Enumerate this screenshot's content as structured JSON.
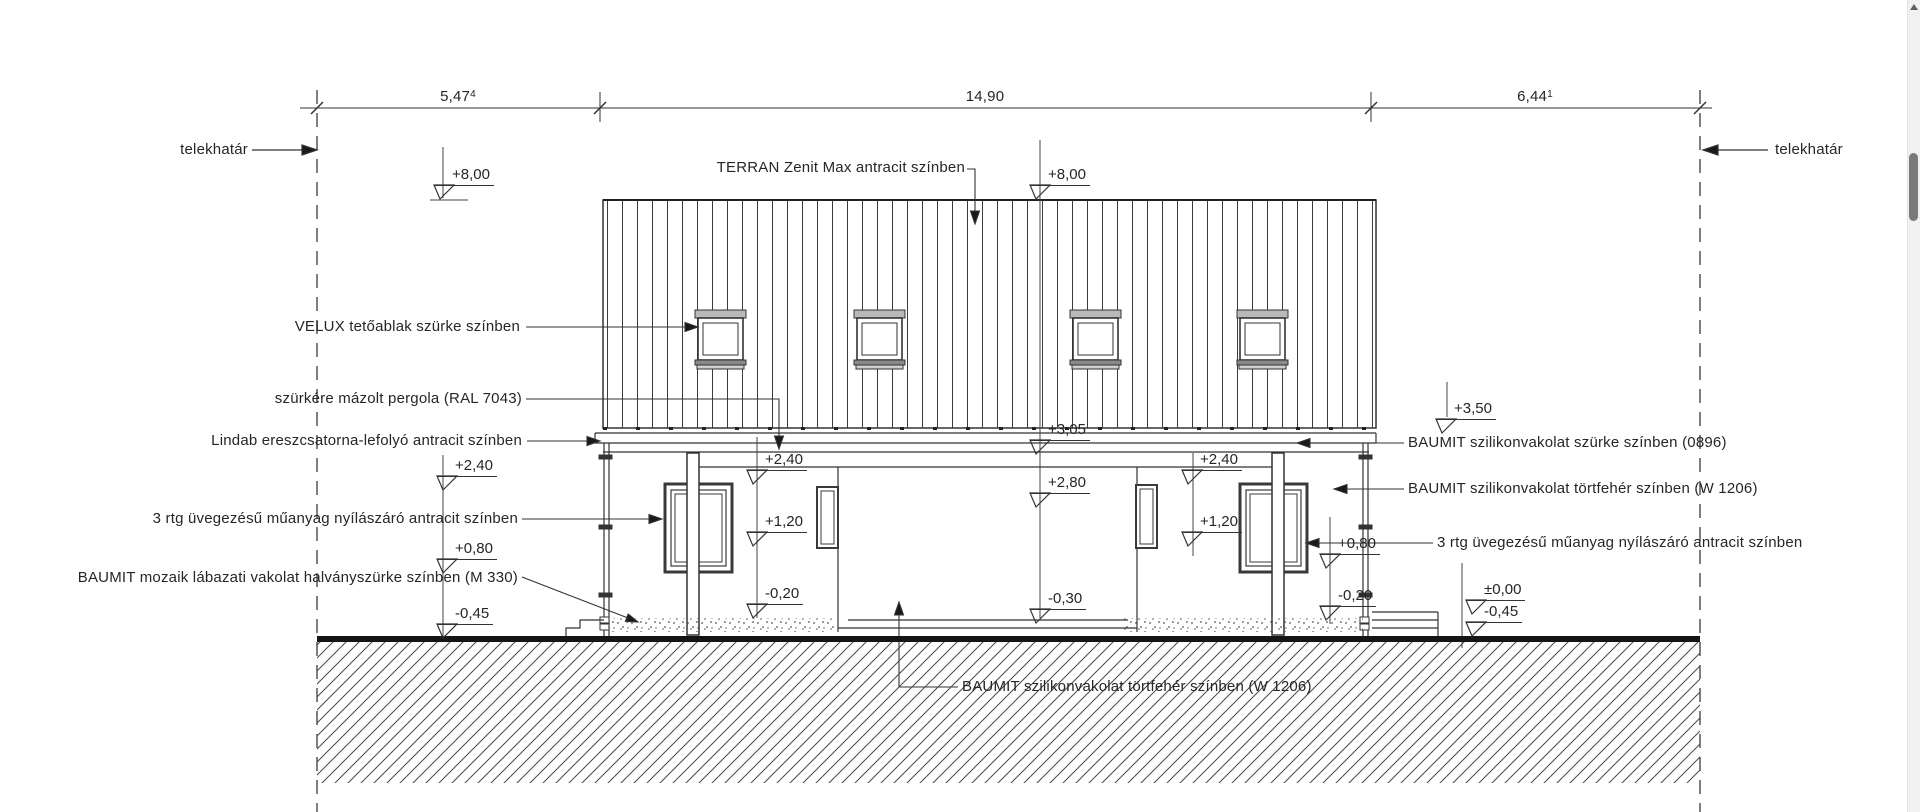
{
  "dimension_row": {
    "segments": [
      {
        "value": "5,47",
        "sup": "4"
      },
      {
        "value": "14,90",
        "sup": ""
      },
      {
        "value": "6,44",
        "sup": "1"
      }
    ]
  },
  "boundary": {
    "left_label": "telekhatár",
    "right_label": "telekhatár"
  },
  "callouts": {
    "roof": "TERRAN Zenit Max antracit színben",
    "velux": "VELUX tetőablak szürke színben",
    "pergola": "szürkére mázolt pergola (RAL 7043)",
    "lindab": "Lindab ereszcsatorna-lefolyó antracit színben",
    "window_left": "3 rtg üvegezésű műanyag nyílászáró antracit színben",
    "plinth": "BAUMIT mozaik lábazati vakolat halványszürke színben (M 330)",
    "render_grey": "BAUMIT szilikonvakolat szürke színben (0896)",
    "render_offwhite": "BAUMIT szilikonvakolat törtfehér színben (W 1206)",
    "window_right": "3 rtg üvegezésű műanyag nyílászáró antracit színben",
    "render_offwhite_bottom": "BAUMIT szilikonvakolat törtfehér színben (W 1206)"
  },
  "elevations": {
    "ridge_left": "+8,00",
    "ridge_center": "+8,00",
    "eave": "+3,05",
    "parapet_right": "+3,50",
    "left_240": "+2,40",
    "left_080": "+0,80",
    "left_045": "-0,45",
    "porch_240": "+2,40",
    "porch_120": "+1,20",
    "porch_020": "-0,20",
    "garage_280": "+2,80",
    "garage_030": "-0,30",
    "right_porch_240": "+2,40",
    "right_porch_120": "+1,20",
    "right_wall_080": "+0,80",
    "right_wall_020": "-0,20",
    "grade_000": "±0,00",
    "grade_045": "-0,45"
  },
  "colors": {
    "line": "#333333",
    "ground": "#151515",
    "scroll_thumb": "#7a7a7a"
  }
}
